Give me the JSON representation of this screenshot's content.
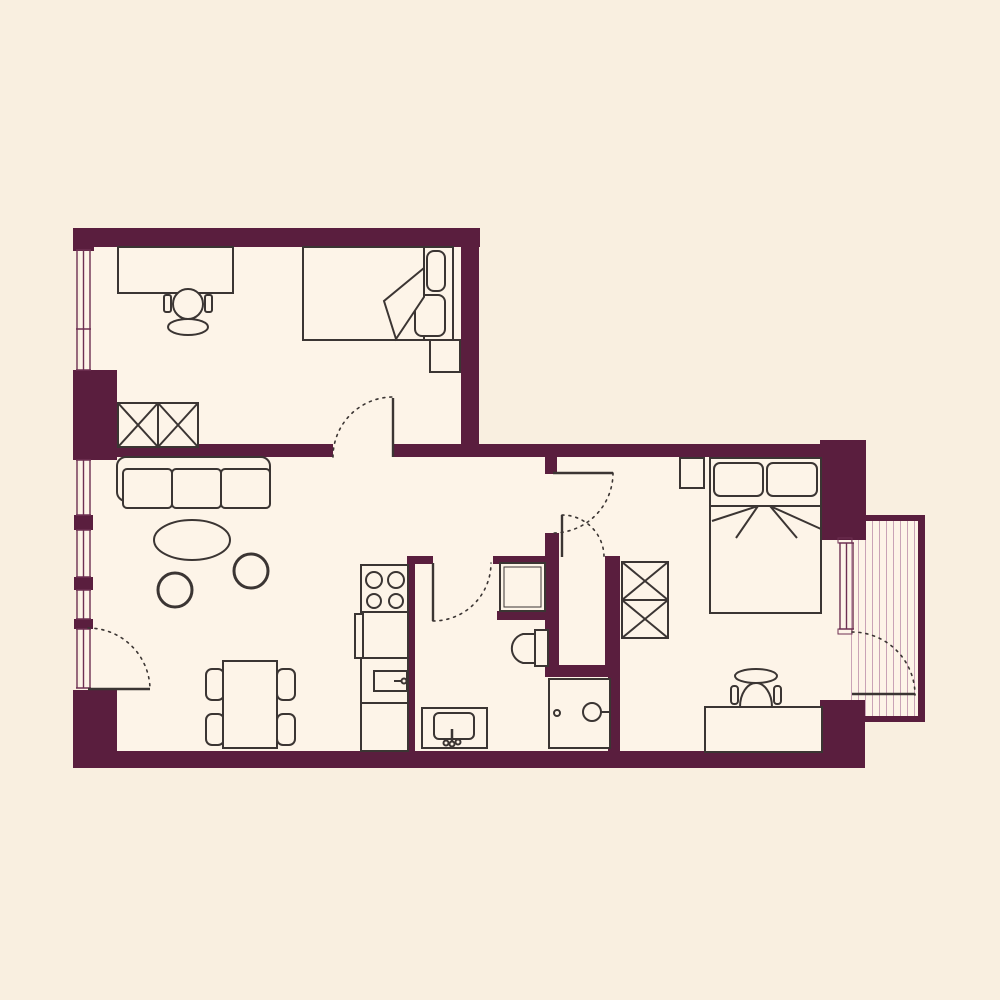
{
  "canvas": {
    "width": 1000,
    "height": 1000,
    "background": "#f9efe0"
  },
  "palette": {
    "wall": "#5a1e3e",
    "floor": "#fdf4e8",
    "line": "#3b3533",
    "window_line": "#6e3052",
    "hatch_line": "#c9a3b6"
  },
  "floorplan": {
    "floors": [
      {
        "name": "office-floor",
        "x": 80,
        "y": 236,
        "w": 392,
        "h": 214
      },
      {
        "name": "main-floor",
        "x": 80,
        "y": 446,
        "w": 776,
        "h": 312
      },
      {
        "name": "balcony-floor",
        "x": 845,
        "y": 517,
        "w": 76,
        "h": 202
      }
    ],
    "walls": [
      {
        "name": "wall-top",
        "x": 73,
        "y": 228,
        "w": 407,
        "h": 19
      },
      {
        "name": "wall-office-right",
        "x": 461,
        "y": 247,
        "w": 18,
        "h": 210
      },
      {
        "name": "wall-mid-left",
        "x": 117,
        "y": 444,
        "w": 216,
        "h": 13
      },
      {
        "name": "wall-mid-right",
        "x": 393,
        "y": 444,
        "w": 429,
        "h": 13
      },
      {
        "name": "wall-left-corner-top",
        "x": 73,
        "y": 228,
        "w": 21,
        "h": 23
      },
      {
        "name": "wall-left-block",
        "x": 73,
        "y": 370,
        "w": 44,
        "h": 90
      },
      {
        "name": "wall-left-small-1",
        "x": 74,
        "y": 515,
        "w": 19,
        "h": 15
      },
      {
        "name": "wall-left-small-2",
        "x": 74,
        "y": 577,
        "w": 19,
        "h": 13
      },
      {
        "name": "wall-left-small-3",
        "x": 74,
        "y": 619,
        "w": 19,
        "h": 10
      },
      {
        "name": "wall-left-corner-bottom",
        "x": 73,
        "y": 690,
        "w": 44,
        "h": 78
      },
      {
        "name": "wall-bottom",
        "x": 73,
        "y": 751,
        "w": 792,
        "h": 17
      },
      {
        "name": "wall-kitchen",
        "x": 407,
        "y": 556,
        "w": 8,
        "h": 196
      },
      {
        "name": "wall-bathdoor-left",
        "x": 407,
        "y": 556,
        "w": 26,
        "h": 8
      },
      {
        "name": "wall-bathdoor-right",
        "x": 493,
        "y": 556,
        "w": 54,
        "h": 8
      },
      {
        "name": "wall-bath-mid",
        "x": 545,
        "y": 533,
        "w": 14,
        "h": 144
      },
      {
        "name": "wall-bedroomdoor-stub",
        "x": 545,
        "y": 455,
        "w": 12,
        "h": 19
      },
      {
        "name": "wall-shower-bottom",
        "x": 497,
        "y": 611,
        "w": 52,
        "h": 9
      },
      {
        "name": "wall-closet-bottom",
        "x": 549,
        "y": 665,
        "w": 68,
        "h": 12
      },
      {
        "name": "wall-bedroom-west",
        "x": 605,
        "y": 556,
        "w": 15,
        "h": 121
      },
      {
        "name": "wall-bedroom-west-low",
        "x": 608,
        "y": 677,
        "w": 12,
        "h": 75
      },
      {
        "name": "wall-ne-block",
        "x": 820,
        "y": 440,
        "w": 46,
        "h": 100
      },
      {
        "name": "wall-se-block",
        "x": 820,
        "y": 700,
        "w": 45,
        "h": 68
      },
      {
        "name": "balcony-parapet-top",
        "x": 866,
        "y": 515,
        "w": 59,
        "h": 6
      },
      {
        "name": "balcony-parapet-right",
        "x": 918,
        "y": 515,
        "w": 7,
        "h": 207
      },
      {
        "name": "balcony-parapet-bottom",
        "x": 845,
        "y": 716,
        "w": 80,
        "h": 6
      }
    ],
    "windows": [
      {
        "name": "window-office",
        "x": 76,
        "y1": 250,
        "y2": 370,
        "tick": 329
      },
      {
        "name": "window-living-1",
        "x": 76,
        "y1": 460,
        "y2": 515
      },
      {
        "name": "window-living-2",
        "x": 76,
        "y1": 530,
        "y2": 577
      },
      {
        "name": "window-living-3",
        "x": 76,
        "y1": 590,
        "y2": 619
      },
      {
        "name": "window-door-glass",
        "x": 76,
        "y1": 629,
        "y2": 688
      },
      {
        "name": "window-bedroom",
        "x": 839,
        "y1": 543,
        "y2": 629,
        "caps": true
      }
    ],
    "hatch": {
      "name": "balcony-decking",
      "x1": 851.5,
      "x2": 915,
      "step": 7,
      "y1": 521,
      "y2": 716
    },
    "doors": [
      {
        "name": "door-office",
        "leaf": [
          393,
          398,
          393,
          457
        ],
        "arc": "M333,457 A60,60 0 0 1 393,397"
      },
      {
        "name": "door-living-balcony",
        "leaf": [
          88,
          689,
          150,
          689
        ],
        "arc": "M88,628 A62,62 0 0 1 150,690"
      },
      {
        "name": "door-bathroom",
        "leaf": [
          433,
          563,
          433,
          621
        ],
        "arc": "M433,621 A58,58 0 0 0 491,563"
      },
      {
        "name": "door-bedroom",
        "leaf": [
          553,
          473,
          613,
          473
        ],
        "arc": "M613,473 A60,60 0 0 1 553,533"
      },
      {
        "name": "door-closet",
        "leaf": [
          562,
          515,
          562,
          557
        ],
        "arc": "M562,515 A42,42 0 0 1 604,557"
      },
      {
        "name": "door-bedroom-balcony",
        "leaf": [
          852,
          694,
          915,
          694
        ],
        "arc": "M852,632 A63,63 0 0 1 915,695"
      }
    ],
    "furniture": [
      {
        "name": "office-desk",
        "type": "rect",
        "x": 118,
        "y": 247,
        "w": 115,
        "h": 46
      },
      {
        "name": "office-chair-arm-left",
        "type": "rect",
        "x": 164,
        "y": 295,
        "w": 7,
        "h": 17,
        "rx": 2
      },
      {
        "name": "office-chair-arm-right",
        "type": "rect",
        "x": 205,
        "y": 295,
        "w": 7,
        "h": 17,
        "rx": 2
      },
      {
        "name": "office-chair-seat",
        "type": "circle",
        "cx": 188,
        "cy": 304,
        "r": 15
      },
      {
        "name": "office-chair-back",
        "type": "ellipse",
        "cx": 188,
        "cy": 327,
        "rx": 20,
        "ry": 8
      },
      {
        "name": "single-bed",
        "type": "rect",
        "x": 303,
        "y": 247,
        "w": 150,
        "h": 93
      },
      {
        "name": "single-bed-headline",
        "type": "line",
        "x1": 424,
        "y1": 247,
        "x2": 424,
        "y2": 340
      },
      {
        "name": "single-bed-pillow-1",
        "type": "rect",
        "x": 427,
        "y": 251,
        "w": 18,
        "h": 40,
        "rx": 7
      },
      {
        "name": "single-bed-pillow-2",
        "type": "rect",
        "x": 415,
        "y": 295,
        "w": 30,
        "h": 41,
        "rx": 7
      },
      {
        "name": "single-bed-blanket",
        "type": "path",
        "d": "M424,268 L384,301 L396,339 L424,297 Z"
      },
      {
        "name": "office-nightstand",
        "type": "rect",
        "x": 430,
        "y": 340,
        "w": 30,
        "h": 32
      },
      {
        "name": "office-wardrobe",
        "type": "rect",
        "x": 118,
        "y": 403,
        "w": 80,
        "h": 44
      },
      {
        "name": "office-wardrobe-mid",
        "type": "line",
        "x1": 158,
        "y1": 403,
        "x2": 158,
        "y2": 447
      },
      {
        "name": "office-wardrobe-x",
        "type": "path",
        "d": "M118,403 L158,447 M158,403 L118,447 M158,403 L198,447 M198,403 L158,447",
        "fill": "none"
      },
      {
        "name": "sofa-frame",
        "type": "rect",
        "x": 117,
        "y": 457,
        "w": 153,
        "h": 44,
        "rx": 9
      },
      {
        "name": "sofa-cushion-1",
        "type": "rect",
        "x": 123,
        "y": 469,
        "w": 49,
        "h": 39,
        "rx": 4
      },
      {
        "name": "sofa-cushion-2",
        "type": "rect",
        "x": 172,
        "y": 469,
        "w": 49,
        "h": 39,
        "rx": 4
      },
      {
        "name": "sofa-cushion-3",
        "type": "rect",
        "x": 221,
        "y": 469,
        "w": 49,
        "h": 39,
        "rx": 4
      },
      {
        "name": "coffee-table",
        "type": "ellipse",
        "cx": 192,
        "cy": 540,
        "rx": 38,
        "ry": 20
      },
      {
        "name": "pouf-1",
        "type": "circle",
        "cx": 251,
        "cy": 571,
        "r": 17,
        "sw": 3
      },
      {
        "name": "pouf-2",
        "type": "circle",
        "cx": 175,
        "cy": 590,
        "r": 17,
        "sw": 3
      },
      {
        "name": "dining-chair-l1",
        "type": "rect",
        "x": 206,
        "y": 669,
        "w": 18,
        "h": 31,
        "rx": 6
      },
      {
        "name": "dining-chair-l2",
        "type": "rect",
        "x": 206,
        "y": 714,
        "w": 18,
        "h": 31,
        "rx": 6
      },
      {
        "name": "dining-chair-r1",
        "type": "rect",
        "x": 277,
        "y": 669,
        "w": 18,
        "h": 31,
        "rx": 6
      },
      {
        "name": "dining-chair-r2",
        "type": "rect",
        "x": 277,
        "y": 714,
        "w": 18,
        "h": 31,
        "rx": 6
      },
      {
        "name": "dining-table",
        "type": "rect",
        "x": 223,
        "y": 661,
        "w": 54,
        "h": 87
      },
      {
        "name": "kitchen-column",
        "type": "rect",
        "x": 361,
        "y": 565,
        "w": 47,
        "h": 186
      },
      {
        "name": "kitchen-sections",
        "type": "path",
        "d": "M361,612 L408,612 M361,658 L408,658 M361,703 L408,703",
        "fill": "none"
      },
      {
        "name": "stove-burner-1",
        "type": "circle",
        "cx": 374,
        "cy": 580,
        "r": 8
      },
      {
        "name": "stove-burner-2",
        "type": "circle",
        "cx": 396,
        "cy": 580,
        "r": 8
      },
      {
        "name": "stove-burner-3",
        "type": "circle",
        "cx": 374,
        "cy": 601,
        "r": 7
      },
      {
        "name": "stove-burner-4",
        "type": "circle",
        "cx": 396,
        "cy": 601,
        "r": 7
      },
      {
        "name": "oven-handle",
        "type": "rect",
        "x": 355,
        "y": 614,
        "w": 8,
        "h": 44
      },
      {
        "name": "microwave",
        "type": "rect",
        "x": 374,
        "y": 671,
        "w": 33,
        "h": 20
      },
      {
        "name": "microwave-handle",
        "type": "line",
        "x1": 394,
        "y1": 681,
        "x2": 402,
        "y2": 681
      },
      {
        "name": "microwave-knob",
        "type": "circle",
        "cx": 404,
        "cy": 681,
        "r": 2.5
      },
      {
        "name": "sink-counter",
        "type": "rect",
        "x": 422,
        "y": 708,
        "w": 65,
        "h": 40
      },
      {
        "name": "sink-basin",
        "type": "rect",
        "x": 434,
        "y": 713,
        "w": 40,
        "h": 26,
        "rx": 5
      },
      {
        "name": "sink-faucet",
        "type": "line",
        "x1": 452,
        "y1": 729,
        "x2": 452,
        "y2": 742,
        "sw": 2.5
      },
      {
        "name": "sink-knob-1",
        "type": "circle",
        "cx": 446,
        "cy": 743,
        "r": 2.5
      },
      {
        "name": "sink-knob-2",
        "type": "circle",
        "cx": 452,
        "cy": 744,
        "r": 2.5
      },
      {
        "name": "sink-knob-3",
        "type": "circle",
        "cx": 458,
        "cy": 742,
        "r": 2.5
      },
      {
        "name": "shower-tray",
        "type": "rect",
        "x": 500,
        "y": 563,
        "w": 45,
        "h": 48
      },
      {
        "name": "shower-tray-inner",
        "type": "rect",
        "x": 504,
        "y": 567,
        "w": 37,
        "h": 40,
        "sw": 1
      },
      {
        "name": "toilet-tank",
        "type": "rect",
        "x": 535,
        "y": 630,
        "w": 13,
        "h": 36
      },
      {
        "name": "toilet-bowl",
        "type": "path",
        "d": "M535,634 L523,634 A15,15 0 0 0 523,663 L535,663 Z"
      },
      {
        "name": "washing-machine",
        "type": "rect",
        "x": 549,
        "y": 679,
        "w": 61,
        "h": 69
      },
      {
        "name": "washer-knob",
        "type": "circle",
        "cx": 557,
        "cy": 713,
        "r": 3
      },
      {
        "name": "washer-door",
        "type": "circle",
        "cx": 592,
        "cy": 712,
        "r": 9
      },
      {
        "name": "washer-hinge",
        "type": "line",
        "x1": 601,
        "y1": 712,
        "x2": 610,
        "y2": 712
      },
      {
        "name": "bedroom-wardrobe",
        "type": "rect",
        "x": 622,
        "y": 562,
        "w": 46,
        "h": 76
      },
      {
        "name": "bedroom-wardrobe-mid",
        "type": "line",
        "x1": 622,
        "y1": 600,
        "x2": 668,
        "y2": 600
      },
      {
        "name": "bedroom-wardrobe-x",
        "type": "path",
        "d": "M622,562 L668,600 M668,562 L622,600 M622,600 L668,638 M668,600 L622,638",
        "fill": "none"
      },
      {
        "name": "bedroom-nightstand",
        "type": "rect",
        "x": 680,
        "y": 458,
        "w": 24,
        "h": 30
      },
      {
        "name": "double-bed",
        "type": "rect",
        "x": 710,
        "y": 458,
        "w": 111,
        "h": 155
      },
      {
        "name": "double-bed-pillow-1",
        "type": "rect",
        "x": 714,
        "y": 463,
        "w": 49,
        "h": 33,
        "rx": 6
      },
      {
        "name": "double-bed-pillow-2",
        "type": "rect",
        "x": 767,
        "y": 463,
        "w": 50,
        "h": 33,
        "rx": 6
      },
      {
        "name": "double-bed-line",
        "type": "line",
        "x1": 710,
        "y1": 506,
        "x2": 821,
        "y2": 506
      },
      {
        "name": "double-bed-folds",
        "type": "path",
        "d": "M758,506 L712,521 M758,506 L736,538 M770,506 L821,529 M770,506 L797,538",
        "fill": "none"
      },
      {
        "name": "bedroom-chair-back",
        "type": "ellipse",
        "cx": 756,
        "cy": 676,
        "rx": 21,
        "ry": 7
      },
      {
        "name": "bedroom-chair-stem",
        "type": "rect",
        "x": 752,
        "y": 683,
        "w": 8,
        "h": 5
      },
      {
        "name": "bedroom-chair-arm-l",
        "type": "rect",
        "x": 731,
        "y": 686,
        "w": 7,
        "h": 18,
        "rx": 3
      },
      {
        "name": "bedroom-chair-arm-r",
        "type": "rect",
        "x": 774,
        "y": 686,
        "w": 7,
        "h": 18,
        "rx": 3
      },
      {
        "name": "bedroom-chair-seat",
        "type": "path",
        "d": "M740,707 A16,24 0 0 1 772,707 Z"
      },
      {
        "name": "bedroom-desk",
        "type": "rect",
        "x": 705,
        "y": 707,
        "w": 117,
        "h": 45
      }
    ]
  }
}
